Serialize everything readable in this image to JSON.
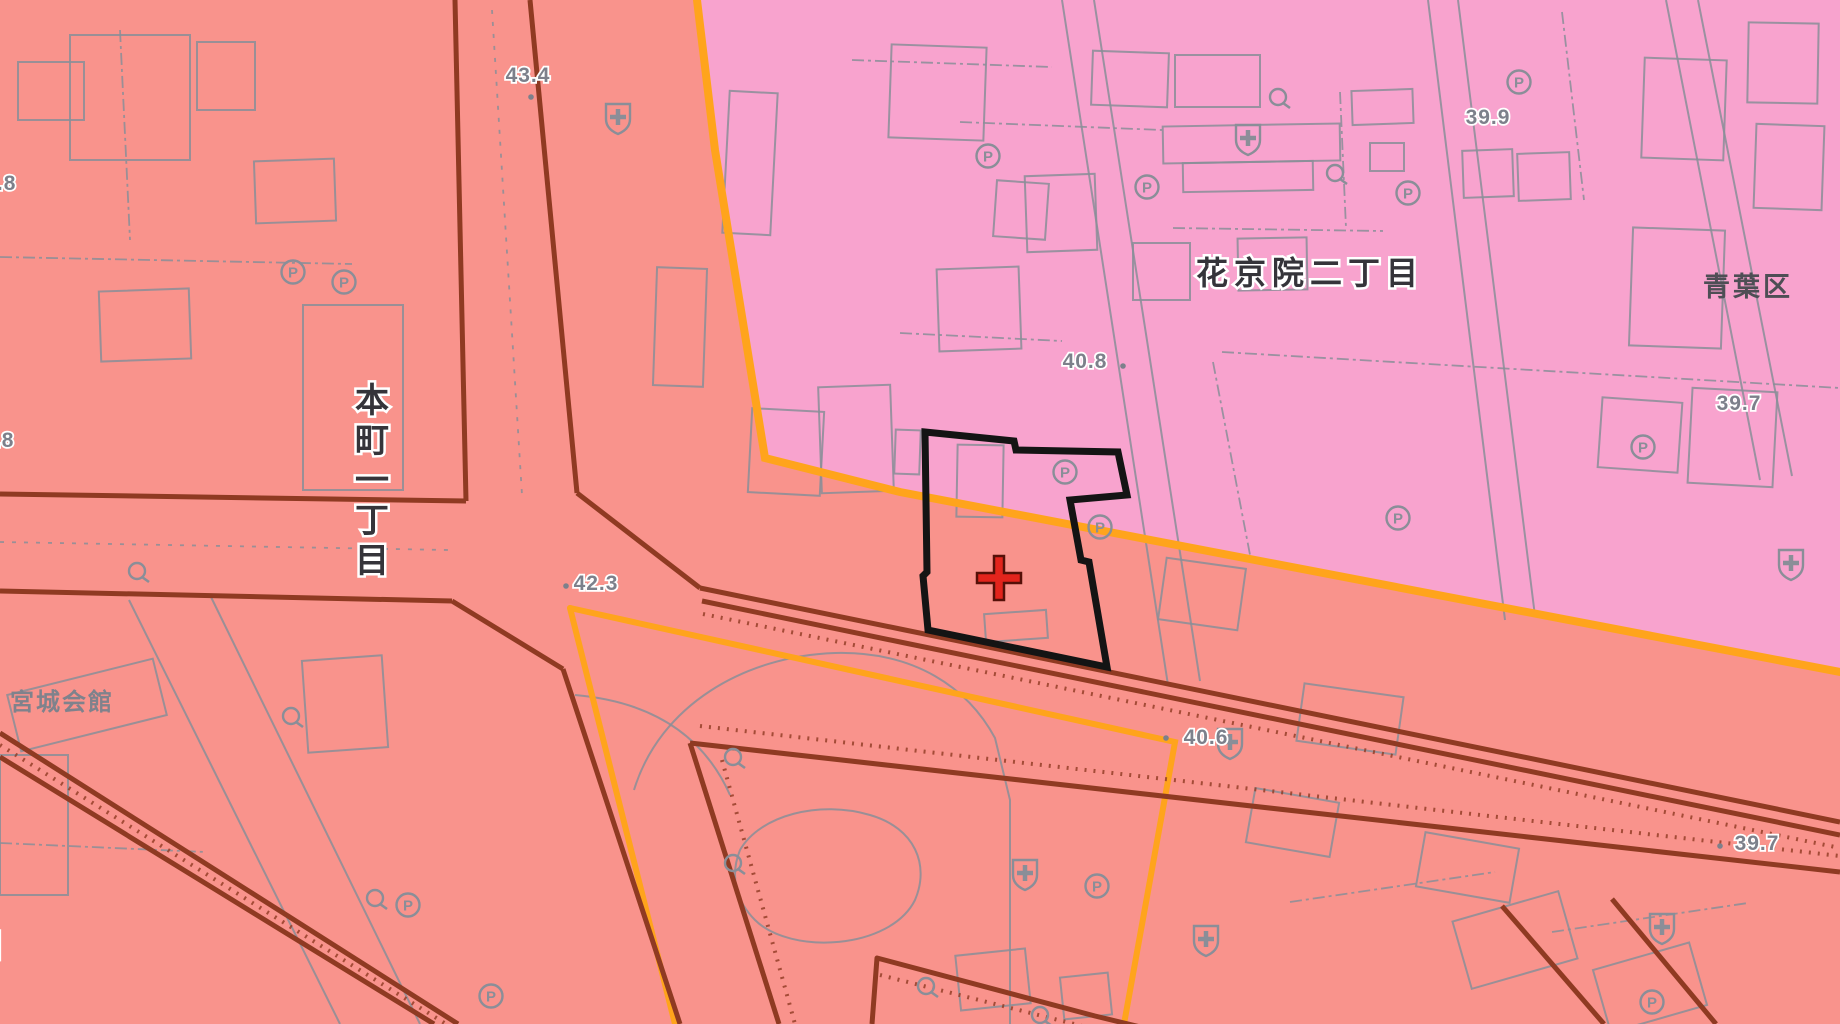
{
  "map": {
    "canvas": {
      "width": 1840,
      "height": 1024
    },
    "colors": {
      "commercial_zone": "#F9938C",
      "residential_zone": "#F8A3CE",
      "zone_boundary_orange": "#FFA41C",
      "road_edge": "#8F3A22",
      "map_line_gray": "#8A8E98",
      "spot_text_gray": "#7D808B",
      "label_dark": "#35343A",
      "halo_white": "#FFFFFF",
      "selection_black": "#141414",
      "cross_red": "#E3241C",
      "cross_outline": "#551008"
    },
    "zones": {
      "pink_polygon": [
        [
          697,
          0
        ],
        [
          715,
          150
        ],
        [
          765,
          458
        ],
        [
          900,
          492
        ],
        [
          1840,
          672
        ],
        [
          1840,
          0
        ]
      ]
    },
    "orange_boundaries": [
      {
        "points": [
          [
            697,
            0
          ],
          [
            715,
            150
          ],
          [
            765,
            458
          ],
          [
            900,
            492
          ],
          [
            1840,
            672
          ]
        ],
        "width": 8
      },
      {
        "points": [
          [
            570,
            608
          ],
          [
            1175,
            742
          ],
          [
            1124,
            1024
          ]
        ],
        "width": 6
      },
      {
        "points": [
          [
            570,
            608
          ],
          [
            675,
            1024
          ]
        ],
        "width": 6
      }
    ],
    "roads": [
      {
        "points": [
          [
            455,
            0
          ],
          [
            466,
            501
          ]
        ]
      },
      {
        "points": [
          [
            530,
            0
          ],
          [
            577,
            493
          ]
        ]
      },
      {
        "points": [
          [
            0,
            494
          ],
          [
            466,
            501
          ]
        ]
      },
      {
        "points": [
          [
            0,
            591
          ],
          [
            452,
            601
          ]
        ]
      },
      {
        "points": [
          [
            452,
            601
          ],
          [
            563,
            669
          ]
        ]
      },
      {
        "points": [
          [
            563,
            669
          ],
          [
            680,
            1024
          ]
        ]
      },
      {
        "points": [
          [
            690,
            743
          ],
          [
            779,
            1024
          ]
        ]
      },
      {
        "points": [
          [
            577,
            493
          ],
          [
            700,
            588
          ]
        ]
      },
      {
        "points": [
          [
            700,
            588
          ],
          [
            905,
            630
          ],
          [
            1840,
            822
          ]
        ]
      },
      {
        "points": [
          [
            702,
            601
          ],
          [
            905,
            643
          ],
          [
            1840,
            835
          ]
        ]
      },
      {
        "points": [
          [
            690,
            743
          ],
          [
            1840,
            872
          ]
        ]
      },
      {
        "points": [
          [
            0,
            733
          ],
          [
            458,
            1024
          ]
        ]
      },
      {
        "points": [
          [
            0,
            757
          ],
          [
            434,
            1024
          ]
        ]
      },
      {
        "points": [
          [
            872,
            1024
          ],
          [
            877,
            958
          ],
          [
            1095,
            1016
          ],
          [
            1285,
            1062
          ]
        ]
      },
      {
        "points": [
          [
            1502,
            906
          ],
          [
            1604,
            1024
          ]
        ]
      },
      {
        "points": [
          [
            1612,
            899
          ],
          [
            1716,
            1024
          ]
        ]
      }
    ],
    "road_hatches": [
      {
        "points": [
          [
            703,
            614
          ],
          [
            1840,
            848
          ]
        ]
      },
      {
        "points": [
          [
            700,
            726
          ],
          [
            1840,
            856
          ]
        ]
      },
      {
        "points": [
          [
            0,
            745
          ],
          [
            446,
            1024
          ]
        ]
      },
      {
        "points": [
          [
            722,
            760
          ],
          [
            795,
            1024
          ]
        ]
      },
      {
        "points": [
          [
            880,
            975
          ],
          [
            1090,
            1028
          ]
        ]
      }
    ],
    "streets": [
      {
        "points": [
          [
            1062,
            0
          ],
          [
            1168,
            685
          ]
        ]
      },
      {
        "points": [
          [
            1094,
            0
          ],
          [
            1200,
            681
          ]
        ]
      },
      {
        "points": [
          [
            1666,
            0
          ],
          [
            1760,
            480
          ]
        ]
      },
      {
        "points": [
          [
            1698,
            0
          ],
          [
            1792,
            476
          ]
        ]
      },
      {
        "points": [
          [
            1428,
            0
          ],
          [
            1505,
            620
          ]
        ]
      },
      {
        "points": [
          [
            1458,
            0
          ],
          [
            1535,
            616
          ]
        ]
      },
      {
        "points": [
          [
            129,
            600
          ],
          [
            340,
            1024
          ]
        ]
      },
      {
        "points": [
          [
            211,
            597
          ],
          [
            420,
            1024
          ]
        ]
      }
    ],
    "dashed_road_lines": [
      {
        "points": [
          [
            492,
            10
          ],
          [
            522,
            495
          ]
        ]
      },
      {
        "points": [
          [
            0,
            542
          ],
          [
            448,
            550
          ]
        ]
      }
    ],
    "parcel_lines": [
      {
        "points": [
          [
            1173,
            228
          ],
          [
            1383,
            231
          ]
        ]
      },
      {
        "points": [
          [
            960,
            122
          ],
          [
            1162,
            130
          ]
        ]
      },
      {
        "points": [
          [
            1340,
            92
          ],
          [
            1346,
            228
          ]
        ]
      },
      {
        "points": [
          [
            1562,
            12
          ],
          [
            1584,
            200
          ]
        ]
      },
      {
        "points": [
          [
            1222,
            352
          ],
          [
            1840,
            388
          ]
        ]
      },
      {
        "points": [
          [
            852,
            60
          ],
          [
            1052,
            67
          ]
        ]
      },
      {
        "points": [
          [
            900,
            333
          ],
          [
            1062,
            341
          ]
        ]
      },
      {
        "points": [
          [
            0,
            257
          ],
          [
            352,
            264
          ]
        ]
      },
      {
        "points": [
          [
            0,
            843
          ],
          [
            205,
            852
          ]
        ]
      },
      {
        "points": [
          [
            1290,
            902
          ],
          [
            1495,
            872
          ]
        ]
      },
      {
        "points": [
          [
            1552,
            932
          ],
          [
            1748,
            903
          ]
        ]
      },
      {
        "points": [
          [
            1213,
            362
          ],
          [
            1251,
            560
          ]
        ]
      },
      {
        "points": [
          [
            120,
            30
          ],
          [
            130,
            240
          ]
        ]
      }
    ],
    "park_paths": [
      "M 634 790 C 660 705 745 656 835 653 C 915 651 968 688 995 738 L 1010 800 L 1010 1024",
      "M 740 850 C 760 815 820 800 870 815 C 915 828 930 865 915 900 C 890 950 790 955 755 920 C 735 900 730 875 740 850",
      "M 575 695 Q 690 705 730 795"
    ],
    "buildings": [
      [
        70,
        35,
        120,
        125,
        0
      ],
      [
        197,
        42,
        58,
        68,
        0
      ],
      [
        18,
        62,
        66,
        58,
        0
      ],
      [
        255,
        160,
        80,
        62,
        -2
      ],
      [
        303,
        305,
        100,
        185,
        0
      ],
      [
        100,
        290,
        90,
        70,
        -2
      ],
      [
        0,
        755,
        68,
        140,
        0
      ],
      [
        12,
        676,
        150,
        58,
        -14
      ],
      [
        305,
        658,
        80,
        92,
        -4
      ],
      [
        655,
        268,
        50,
        118,
        2
      ],
      [
        750,
        410,
        72,
        84,
        3
      ],
      [
        726,
        92,
        48,
        142,
        3
      ],
      [
        1175,
        55,
        85,
        52,
        0
      ],
      [
        1163,
        125,
        177,
        37,
        -1
      ],
      [
        1183,
        162,
        130,
        29,
        -1
      ],
      [
        1352,
        90,
        61,
        34,
        -2
      ],
      [
        1370,
        143,
        34,
        28,
        0
      ],
      [
        1463,
        150,
        50,
        47,
        -2
      ],
      [
        1518,
        153,
        52,
        47,
        -2
      ],
      [
        1238,
        238,
        69,
        52,
        -1
      ],
      [
        1133,
        243,
        57,
        57,
        0
      ],
      [
        1092,
        52,
        76,
        54,
        2
      ],
      [
        890,
        46,
        95,
        93,
        2
      ],
      [
        1026,
        175,
        70,
        76,
        -2
      ],
      [
        938,
        268,
        82,
        82,
        -2
      ],
      [
        995,
        182,
        52,
        56,
        4
      ],
      [
        1643,
        59,
        82,
        100,
        2
      ],
      [
        1748,
        23,
        70,
        80,
        1
      ],
      [
        1631,
        229,
        92,
        118,
        2
      ],
      [
        1755,
        125,
        68,
        84,
        2
      ],
      [
        1690,
        390,
        85,
        95,
        3
      ],
      [
        1600,
        400,
        80,
        70,
        4
      ],
      [
        957,
        445,
        46,
        72,
        1
      ],
      [
        985,
        612,
        62,
        28,
        -4
      ],
      [
        895,
        430,
        25,
        44,
        2
      ],
      [
        820,
        386,
        72,
        106,
        -2
      ],
      [
        1162,
        563,
        80,
        62,
        8
      ],
      [
        1300,
        690,
        100,
        58,
        8
      ],
      [
        1250,
        795,
        85,
        55,
        10
      ],
      [
        1420,
        840,
        95,
        55,
        10
      ],
      [
        1460,
        905,
        110,
        70,
        -16
      ],
      [
        1600,
        955,
        100,
        65,
        -16
      ],
      [
        958,
        952,
        70,
        55,
        -6
      ],
      [
        1062,
        975,
        48,
        42,
        -6
      ]
    ],
    "icons": {
      "parking": [
        [
          293,
          272
        ],
        [
          344,
          282
        ],
        [
          988,
          156
        ],
        [
          1147,
          187
        ],
        [
          1408,
          193
        ],
        [
          1519,
          82
        ],
        [
          1643,
          447
        ],
        [
          1065,
          472
        ],
        [
          1100,
          527
        ],
        [
          1398,
          518
        ],
        [
          1097,
          886
        ],
        [
          408,
          905
        ],
        [
          491,
          996
        ],
        [
          1652,
          1002
        ]
      ],
      "parking_letter": "P",
      "hospital": [
        [
          618,
          117
        ],
        [
          1248,
          138
        ],
        [
          1791,
          563
        ],
        [
          1230,
          742
        ],
        [
          1025,
          873
        ],
        [
          1206,
          939
        ],
        [
          1662,
          927
        ]
      ],
      "utility": [
        [
          1278,
          97
        ],
        [
          1335,
          173
        ],
        [
          137,
          571
        ],
        [
          291,
          716
        ],
        [
          375,
          898
        ],
        [
          733,
          757
        ],
        [
          733,
          863
        ],
        [
          926,
          986
        ],
        [
          1040,
          1015
        ]
      ]
    },
    "spot_elevations": [
      {
        "value": "43.4",
        "x": 528,
        "y": 82,
        "dot": [
          531,
          97
        ]
      },
      {
        "value": "43.8",
        "x": -6,
        "y": 190,
        "dot": null
      },
      {
        "value": "43.8",
        "x": -8,
        "y": 447,
        "dot": null
      },
      {
        "value": "39.9",
        "x": 1488,
        "y": 124,
        "dot": null
      },
      {
        "value": "40.8",
        "x": 1085,
        "y": 368,
        "dot": [
          1123,
          366
        ]
      },
      {
        "value": "39.7",
        "x": 1739,
        "y": 410,
        "dot": null
      },
      {
        "value": "42.3",
        "x": 596,
        "y": 590,
        "dot": [
          566,
          586
        ]
      },
      {
        "value": "40.6",
        "x": 1206,
        "y": 744,
        "dot": [
          1166,
          738
        ]
      },
      {
        "value": "39.7",
        "x": 1757,
        "y": 850,
        "dot": [
          1720,
          846
        ]
      }
    ],
    "labels": [
      {
        "text": "花京院二丁目",
        "x": 1310,
        "y": 284,
        "size": 32,
        "ls": 6,
        "color": "#35343A",
        "halo": true,
        "vertical": false,
        "name": "district-label-kakyoin-2chome"
      },
      {
        "text": "本町一丁目",
        "x": 372,
        "y": 412,
        "size": 34,
        "ls": 0,
        "color": "#35343A",
        "halo": true,
        "vertical": true,
        "name": "district-label-honcho-1chome"
      },
      {
        "text": "宮城会館",
        "x": 62,
        "y": 710,
        "size": 24,
        "ls": 2,
        "color": "#7F828C",
        "halo": false,
        "vertical": false,
        "name": "poi-label-miyagi-kaikan"
      },
      {
        "text": "青葉区",
        "x": 1748,
        "y": 296,
        "size": 27,
        "ls": 3,
        "color": "#4E4E55",
        "halo": false,
        "vertical": false,
        "name": "ward-label-aoba-ku"
      },
      {
        "text": "目",
        "x": -12,
        "y": 956,
        "size": 30,
        "ls": 0,
        "color": "#2A2A2E",
        "halo": true,
        "vertical": false,
        "name": "district-label-partial"
      }
    ],
    "selected_parcel": {
      "outline": [
        [
          925,
          432
        ],
        [
          1014,
          441
        ],
        [
          1016,
          450
        ],
        [
          1118,
          452
        ],
        [
          1127,
          495
        ],
        [
          1070,
          500
        ],
        [
          1081,
          560
        ],
        [
          1089,
          562
        ],
        [
          1107,
          667
        ],
        [
          928,
          630
        ],
        [
          923,
          576
        ],
        [
          927,
          572
        ]
      ],
      "cross": {
        "x": 999,
        "y": 578,
        "arm": 22,
        "half_thickness": 5
      }
    }
  }
}
